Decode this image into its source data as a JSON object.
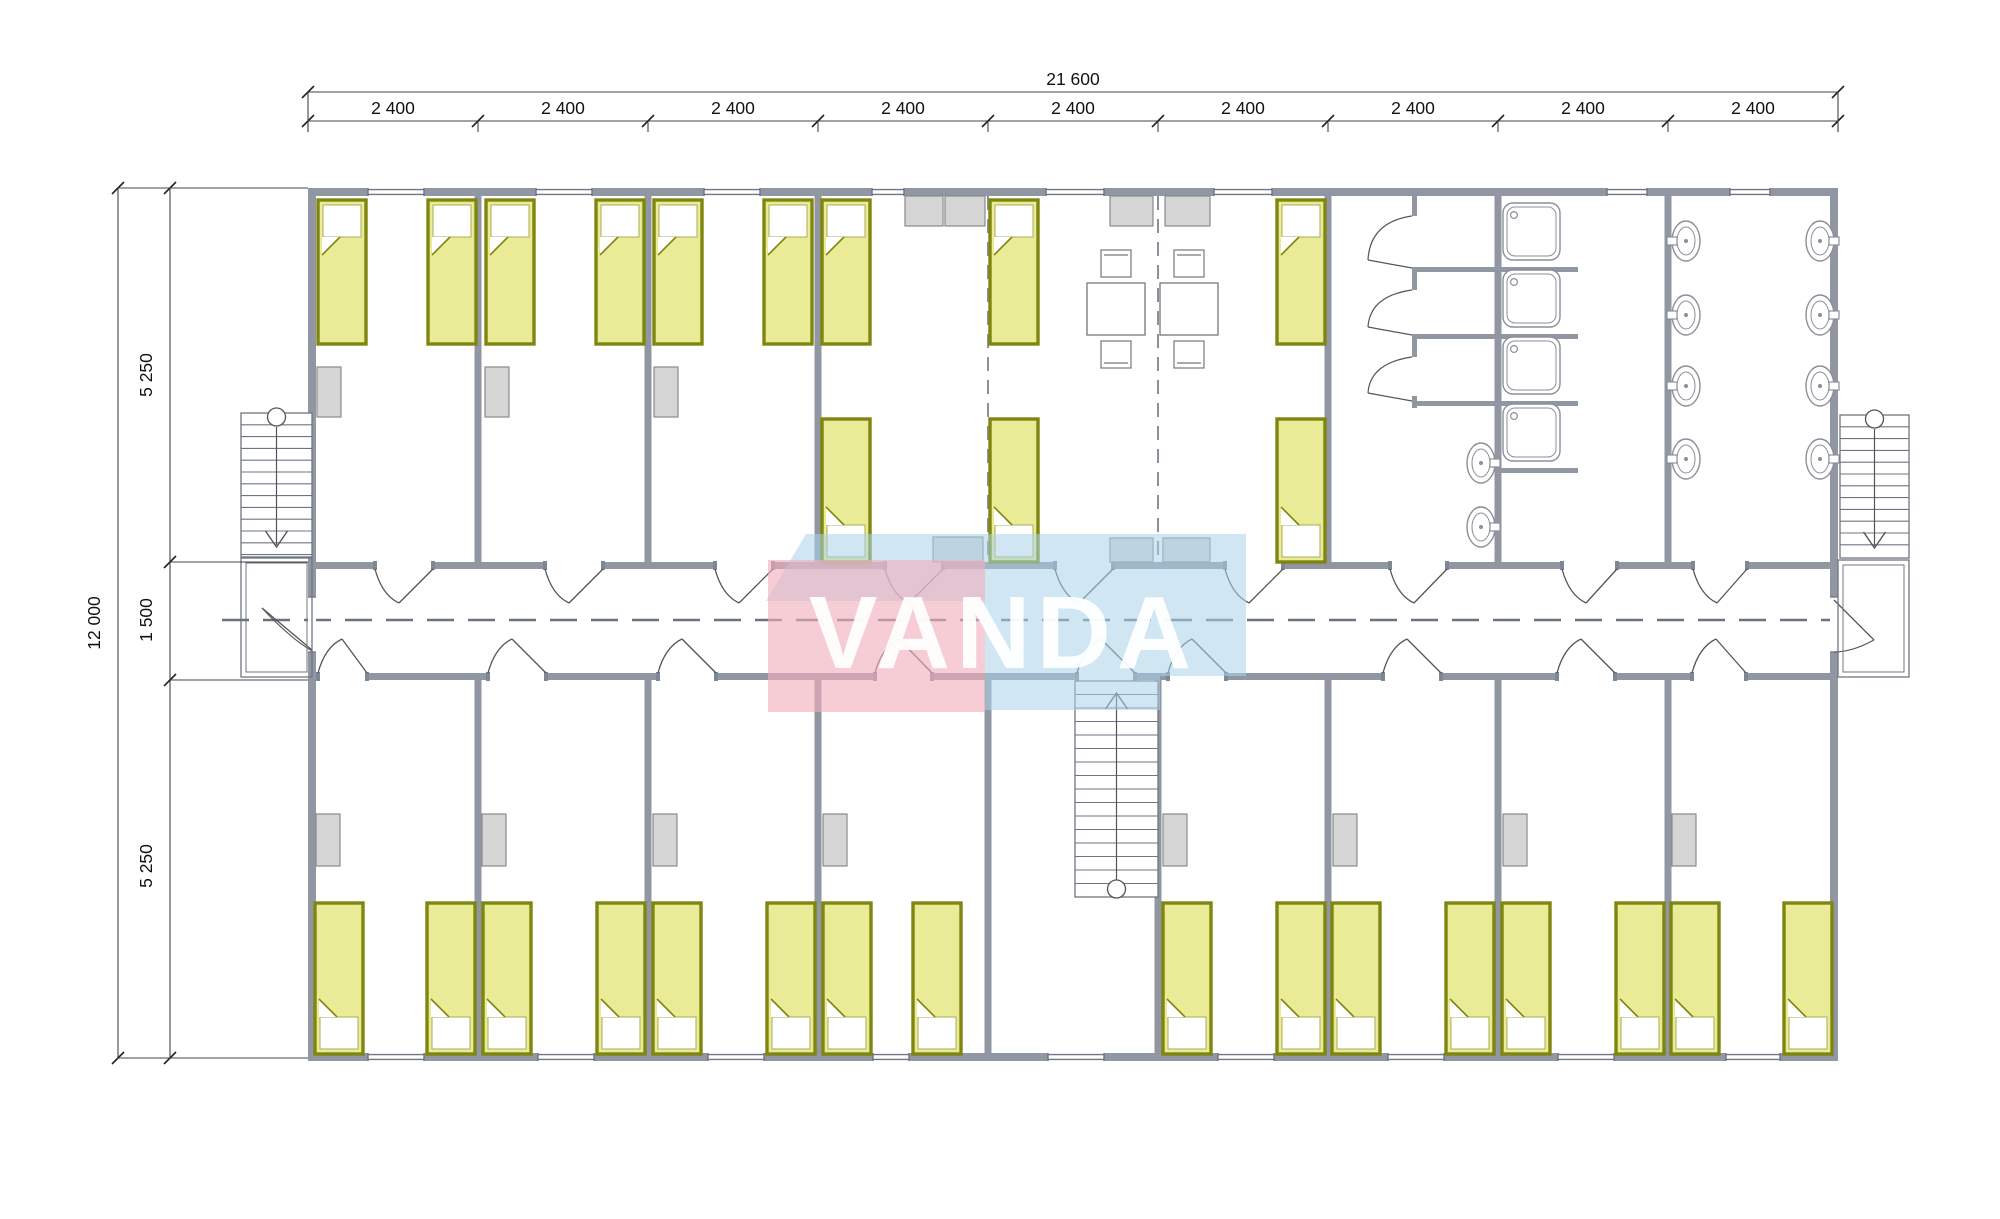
{
  "dims": {
    "top_total": "21 600",
    "top_modules": [
      "2 400",
      "2 400",
      "2 400",
      "2 400",
      "2 400",
      "2 400",
      "2 400",
      "2 400",
      "2 400"
    ],
    "left_total": "12 000",
    "left_chain": [
      "5 250",
      "1 500",
      "5 250"
    ]
  },
  "watermark": {
    "text": "VANDA",
    "pink": "#f2aebc",
    "blue": "#a9d4ea",
    "text_color": "#ffffff"
  },
  "colors": {
    "wall": "#9096a2",
    "wall_cap": "#7d8896",
    "bed_border": "#7f860f",
    "bed_fill": "#e9eb97",
    "pillow": "#ffffff",
    "wardrobe_fill": "#d5d5d5",
    "wardrobe_stroke": "#8a8a8a",
    "thin_line": "#6f7580",
    "dashed": "#8a919c",
    "dim_text": "#111111",
    "background": "#ffffff"
  },
  "fixtures": {
    "bed": {
      "label": "bed",
      "count": 28
    },
    "wardrobe": {
      "label": "wardrobe",
      "count": 11
    },
    "cabinet": {
      "label": "cabinet",
      "count": 7
    },
    "dining_table": {
      "label": "table",
      "count": 2
    },
    "chair": {
      "label": "chair",
      "count": 4
    },
    "shower_tray": {
      "label": "shower tray",
      "count": 4
    },
    "toilet_stall": {
      "label": "toilet stall",
      "count": 3
    },
    "washbasin": {
      "label": "washbasin",
      "count": 10
    },
    "staircase": {
      "label": "staircase",
      "count": 3
    },
    "balcony": {
      "label": "entrance landing",
      "count": 2
    }
  }
}
